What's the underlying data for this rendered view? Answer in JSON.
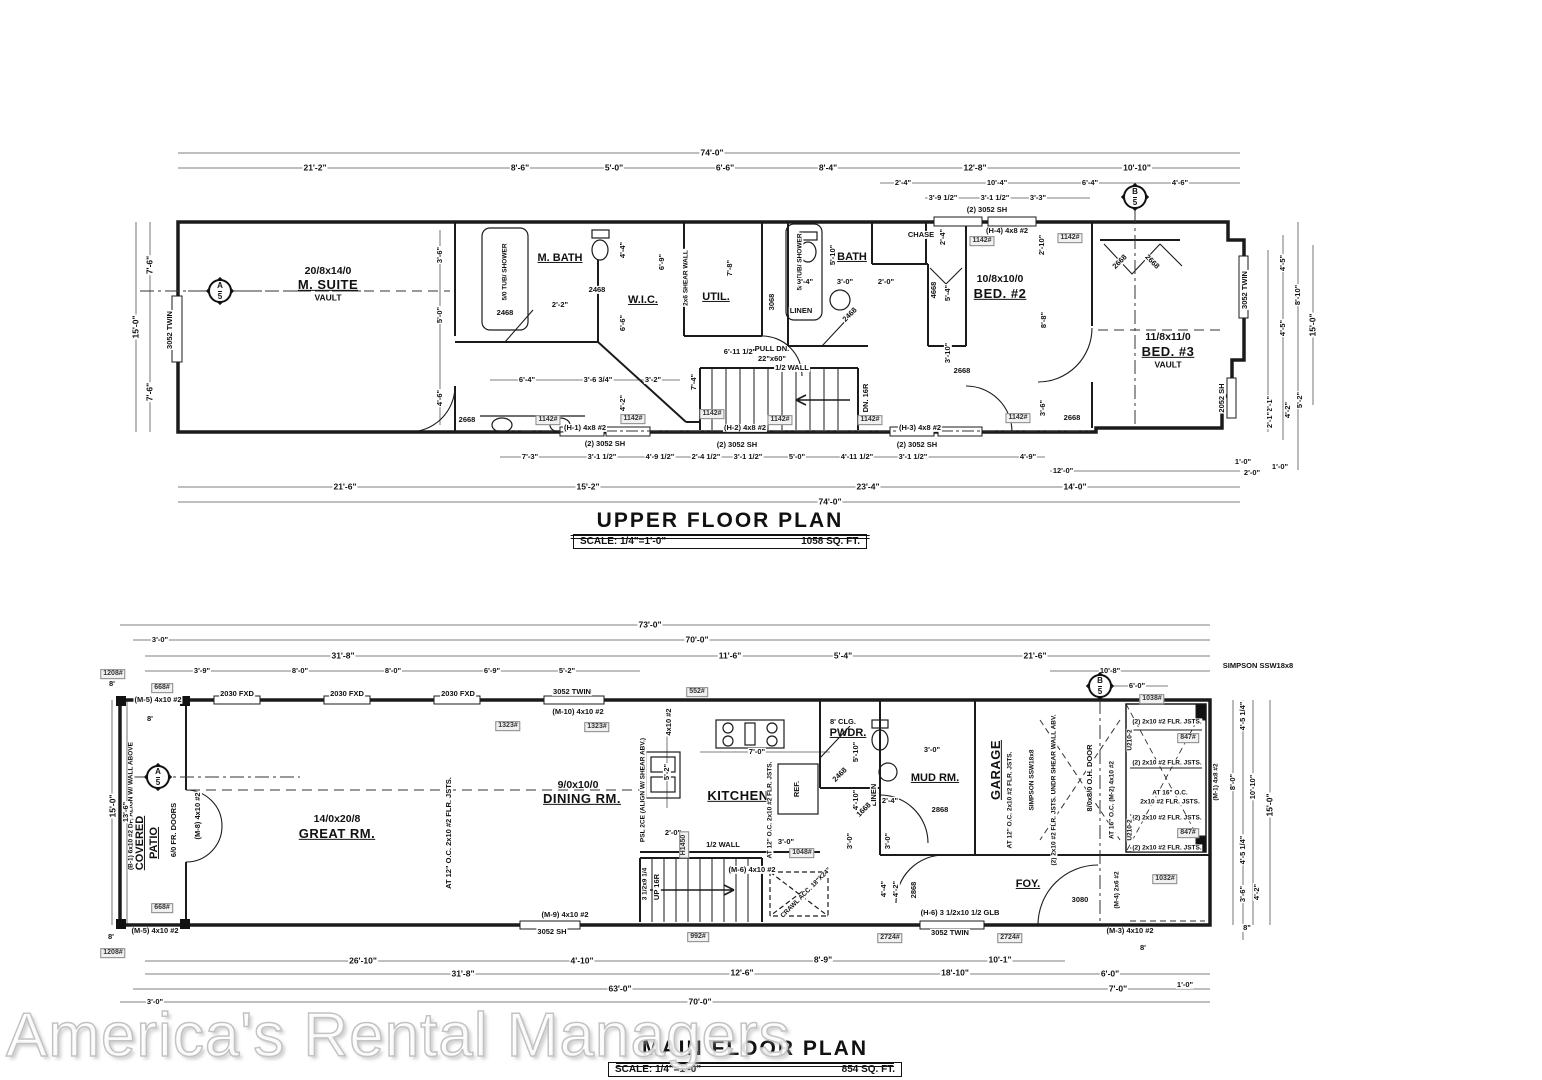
{
  "watermark": "America's Rental Managers",
  "markers": {
    "a": "A",
    "b": "B",
    "n": "5"
  },
  "dims": {
    "d74_0": "74'-0\"",
    "d21_2": "21'-2\"",
    "d8_6": "8'-6\"",
    "d5_0": "5'-0\"",
    "d6_6": "6'-6\"",
    "d8_4": "8'-4\"",
    "d12_8": "12'-8\"",
    "d10_10v": "10'-10\"",
    "d2_4": "2'-4\"",
    "d10_4": "10'-4\"",
    "d6_4": "6'-4\"",
    "d4_6": "4'-6\"",
    "d3_9h": "3'-9 1/2\"",
    "d3_1h": "3'-1 1/2\"",
    "d3_3": "3'-3\"",
    "d7_6": "7'-6\"",
    "d15_0": "15'-0\"",
    "d3_6": "3'-6\"",
    "d4_4": "4'-4\"",
    "d6_9": "6'-9\"",
    "d4_2": "4'-2\"",
    "d7_4": "7'-4\"",
    "d6_11h": "6'-11 1/2\"",
    "d3_6q": "3'-6 3/4\"",
    "d3_2": "3'-2\"",
    "d2_2": "2'-2\"",
    "d7_8": "7'-8\"",
    "d3_4": "3'-4\"",
    "d3_0": "3'-0\"",
    "d2_0": "2'-0\"",
    "d5_10": "5'-10\"",
    "d3_10": "3'-10\"",
    "d4_8": "4'-8\"",
    "d2_10": "2'-10\"",
    "d8_8": "8'-8\"",
    "d5_4": "5'-4\"",
    "d4_5": "4'-5\"",
    "d8_10": "8'-10\"",
    "d5_2": "5'-2\"",
    "d2_1": "2'-1\"",
    "d1_0": "1'-0\"",
    "d7_3": "7'-3\"",
    "d4_9h": "4'-9 1/2\"",
    "d2_4h": "2'-4 1/2\"",
    "d4_11h": "4'-11 1/2\"",
    "d4_9": "4'-9\"",
    "d21_6": "21'-6\"",
    "d15_2": "15'-2\"",
    "d23_4": "23'-4\"",
    "d12_0": "12'-0\"",
    "d14_0": "14'-0\"",
    "d73_0": "73'-0\"",
    "d70_0": "70'-0\"",
    "d31_8": "31'-8\"",
    "d3_9": "3'-9\"",
    "d8_0": "8'-0\"",
    "d11_6": "11'-6\"",
    "d10_8": "10'-8\"",
    "d6_0": "6'-0\"",
    "d8in": "8\"",
    "d8ft": "8'",
    "d13_6": "13'-6\"",
    "d7_0": "7'-0\"",
    "d4_10": "4'-10\"",
    "d4_5q": "4'-5 1/4\"",
    "d26_10": "26'-10\"",
    "d8_9": "8'-9\"",
    "d10_1": "10'-1\"",
    "d12_6": "12'-6\"",
    "d18_10": "18'-10\"",
    "d63_0": "63'-0\""
  },
  "upper": {
    "title": "UPPER FLOOR PLAN",
    "scale": "SCALE: 1/4\"=1'-0\"",
    "area": "1058 SQ. FT.",
    "rooms": {
      "msuite_size": "20/8x14/0",
      "msuite": "M. SUITE",
      "vault": "VAULT",
      "mbath": "M. BATH",
      "wic": "W.I.C.",
      "util": "UTIL.",
      "linen": "LINEN",
      "bath": "BATH",
      "chase": "CHASE",
      "bed2_size": "10/8x10/0",
      "bed2": "BED. #2",
      "bed3_size": "11/8x11/0",
      "bed3": "BED. #3"
    },
    "notes": {
      "tub": "5/0 TUB/ SHOWER",
      "shear": "2x6 SHEAR WALL",
      "pull_dn": "PULL DN.",
      "pull_dn_size": "22\"x60\"",
      "half_wall": "1/2 WALL",
      "dn": "DN. 16R"
    },
    "openings": {
      "d2468": "2468",
      "d2668": "2668",
      "d4668": "4668",
      "d3068": "3068",
      "w3052t": "3052 TWIN",
      "w2052": "2052 SH",
      "w3052pair": "(2) 3052 SH"
    },
    "headers": {
      "h1": "(H-1) 4x8 #2",
      "h2": "(H-2) 4x8 #2",
      "h3": "(H-3) 4x8 #2",
      "h4": "(H-4) 4x8 #2",
      "load": "1142#"
    }
  },
  "main": {
    "title": "MAIN FLOOR PLAN",
    "scale": "SCALE: 1/4\"=1'-0\"",
    "area": "854 SQ. FT.",
    "rooms": {
      "patio1": "COVERED",
      "patio2": "PATIO",
      "great_size": "14/0x20/8",
      "great": "GREAT RM.",
      "dining_size": "9/0x10/0",
      "dining": "DINING RM.",
      "kitchen": "KITCHEN",
      "pwdr": "PWDR.",
      "mud": "MUD RM.",
      "garage": "GARAGE",
      "foy": "FOY.",
      "linen": "LINEN",
      "ref": "REF."
    },
    "notes": {
      "clg": "8' CLG.",
      "frdoors": "6/0 FR. DOORS",
      "joists12": "AT 12\" O.C. 2x10 #2 FLR. JSTS.",
      "psl": "PSL 2CE (ALIGN W/ SHEAR ABV.)",
      "p4x10": "4x10 #2",
      "b1": "(B-1) 6x10 #2 DF, ALIGN W/ WALL ABOVE",
      "m1": "(M-1) 4x8 #2",
      "m2": "AT 16\" O.C. (M-2) 4x10 #2",
      "m3": "(M-3) 4x10 #2",
      "m4": "(M-4) 2x6 #2",
      "m5": "(M-5) 4x10 #2",
      "m6": "(M-6) 4x10 #2",
      "m8": "(M-8) 4x10 #2",
      "m9": "(M-9) 4x10 #2",
      "m10": "(M-10) 4x10 #2",
      "h6": "(H-6) 3 1/2x10 1/2 GLB",
      "halfwall": "1/2 WALL",
      "up": "UP 16R",
      "stringer": "3 1/2x9 1/4",
      "crawl": "CRAWL ACC. 18\"X24\"",
      "ohdoor": "8/0x8/0 O.H. DOOR",
      "simpson": "SIMPSON SSW18x8",
      "shear_under": "(2) 2x10 #2 FLR. JSTS. UNDR SHEAR WALL ABV.",
      "flr2": "(2) 2x10 #2 FLR. JSTS.",
      "at16": "AT 16\" O.C.",
      "flr": "2x10 #2 FLR. JSTS.",
      "u210": "U210-2",
      "h1450": "H1450"
    },
    "openings": {
      "w2030": "2030 FXD",
      "w3052t": "3052 TWIN",
      "w3052s": "3052 SH",
      "d3080": "3080",
      "d2868": "2868",
      "d2468": "2468",
      "d1668": "1668"
    },
    "tags": {
      "t668": "668#",
      "t1208": "1208#",
      "t1323": "1323#",
      "t552": "552#",
      "t992": "992#",
      "t2724": "2724#",
      "t847": "847#",
      "t1038": "1038#",
      "t1032": "1032#",
      "t1048": "1048#"
    }
  }
}
